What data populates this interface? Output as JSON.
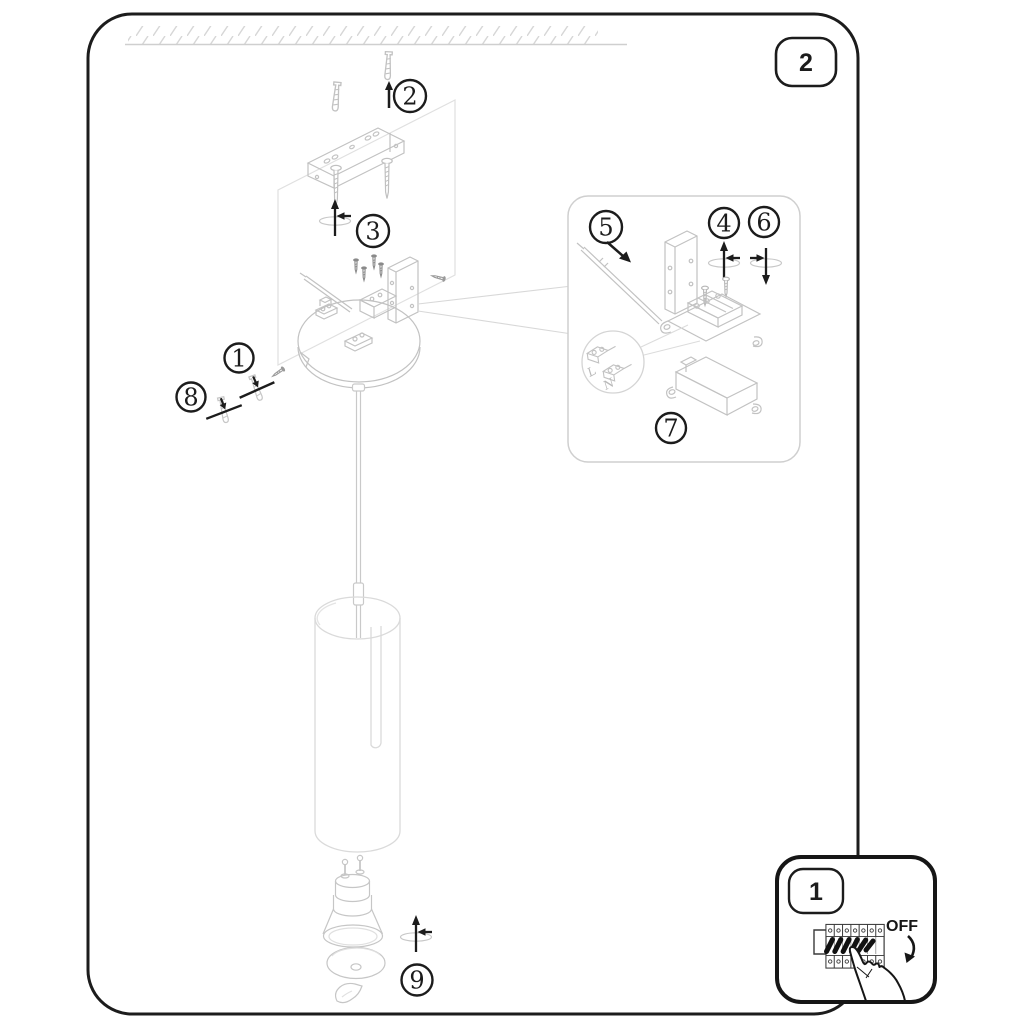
{
  "document_kind": "lamp-assembly-instruction-diagram",
  "colors": {
    "ink": "#1c1c1c",
    "line_art": "#c2c2c2",
    "faint_line": "#dcdcdc",
    "panel_border": "#cfcfcf",
    "paper": "#ffffff"
  },
  "step_badges": {
    "step2": "2"
  },
  "callouts": {
    "c1": "1",
    "c2": "2",
    "c3": "3",
    "c4": "4",
    "c5": "5",
    "c6": "6",
    "c7": "7",
    "c8": "8",
    "c9": "9"
  },
  "power_inset": {
    "badge_label": "1",
    "off_label": "OFF"
  },
  "wiring": {
    "live": "L",
    "neutral": "N"
  },
  "icons": {
    "adjust_icon": "cross-arrows",
    "insert_arrow_icon": "arrow-up",
    "rotate_off_icon": "curved-arrow",
    "hand_icon": "pointing-hand",
    "magnifier_icon": "detail-circle"
  }
}
